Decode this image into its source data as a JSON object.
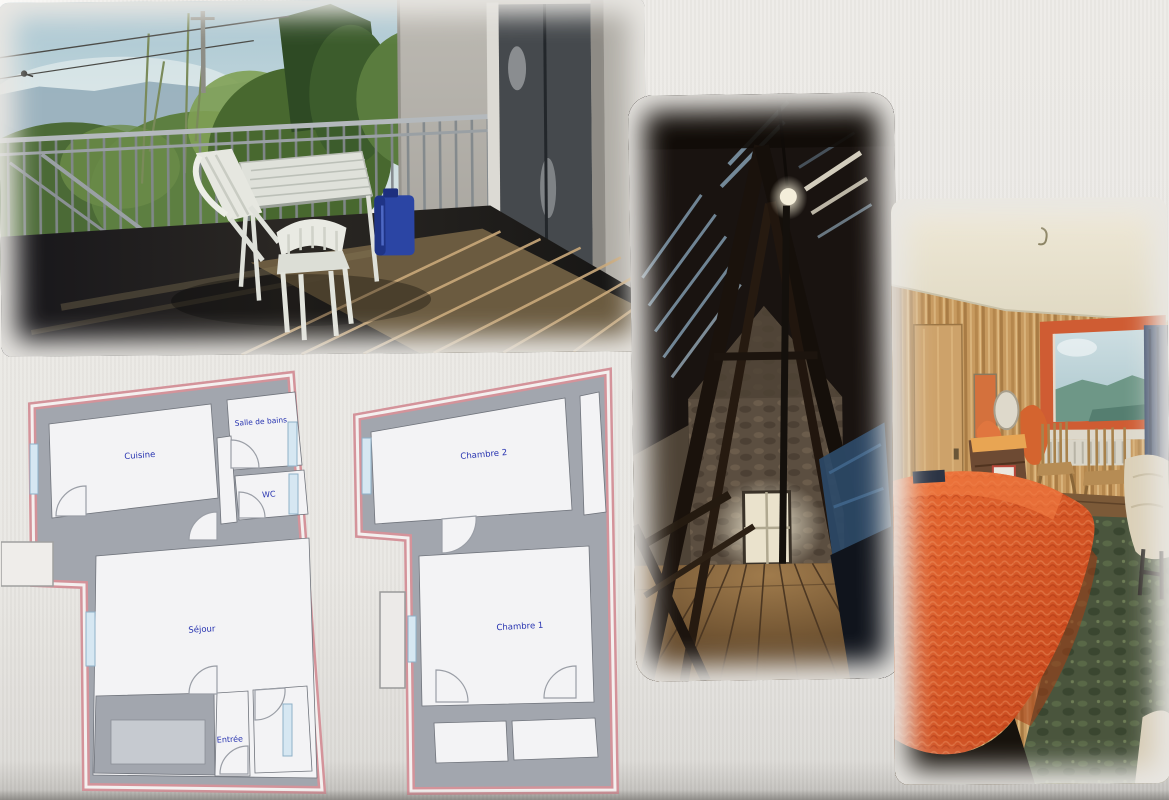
{
  "collage": {
    "photos": {
      "terrace": "terrace-photo",
      "attic": "attic-photo",
      "bedroom": "bedroom-photo"
    },
    "plans": {
      "plan1": {
        "cuisine": "Cuisine",
        "salle_de_bains": "Salle de bains",
        "wc": "WC",
        "sejour": "Séjour",
        "entree": "Entrée"
      },
      "plan2": {
        "chambre2": "Chambre 2",
        "chambre1": "Chambre 1"
      }
    },
    "colors": {
      "background": "#e9e7e3",
      "plan_outline_pink": "#d4939a",
      "plan_wall_gray": "#a2a6ae",
      "plan_room_white": "#f3f3f5",
      "plan_label_blue": "#2733b0",
      "plan_window_blue": "#d6e7f2",
      "bedspread_orange": "#d85626",
      "jerrycan_blue": "#2b45a4"
    }
  }
}
